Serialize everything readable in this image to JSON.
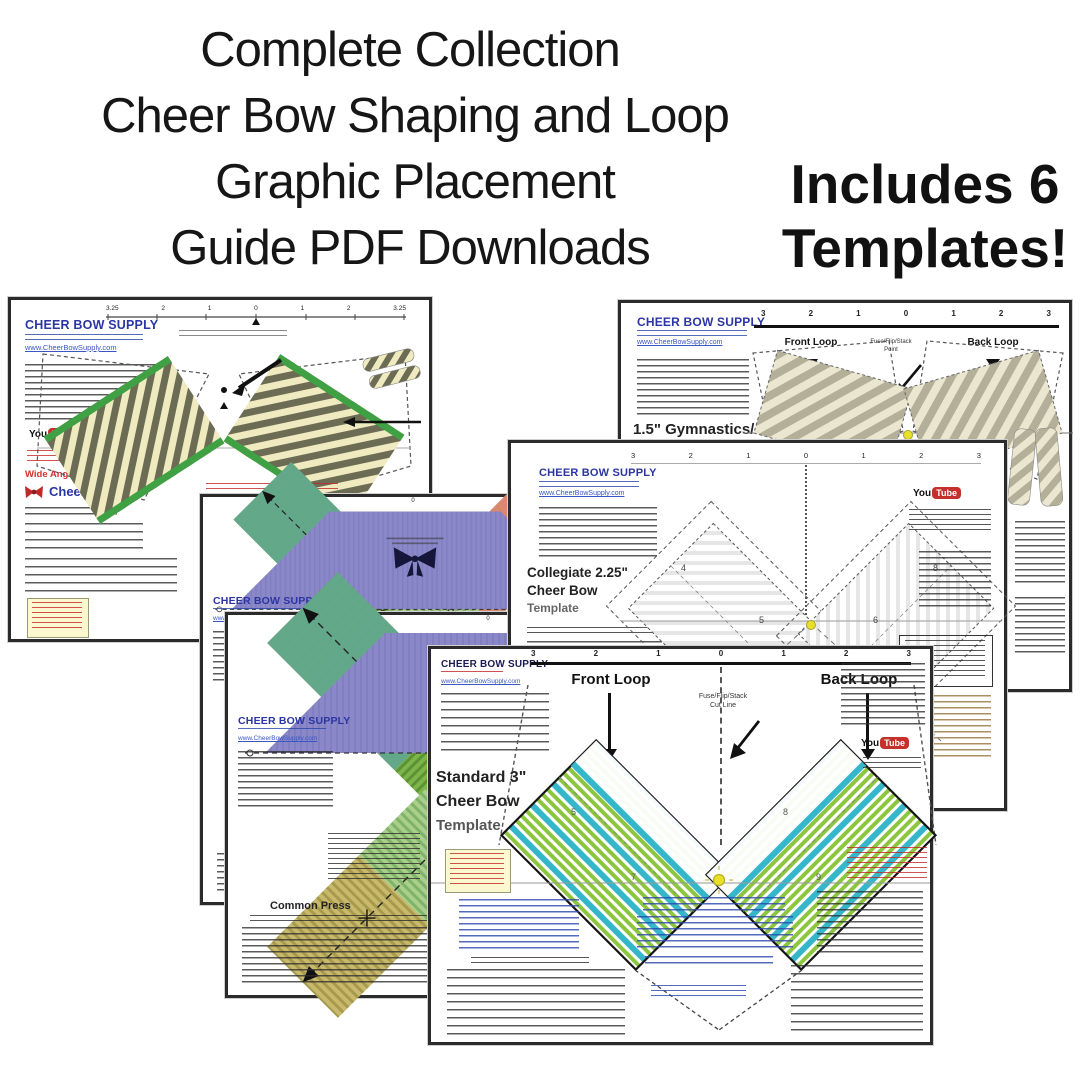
{
  "header": {
    "line1": "Complete Collection",
    "line2": "Cheer Bow Shaping and Loop",
    "line3": "Graphic Placement",
    "line4": "Guide PDF Downloads",
    "badge_line1": "Includes 6",
    "badge_line2": "Templates!"
  },
  "brand": {
    "logo": "CHEER BOW SUPPLY",
    "website": "www.CheerBowSupply.com",
    "youtube_you": "You",
    "youtube_tube": "Tube"
  },
  "colors": {
    "accent_blue": "#2b35a3",
    "link_blue": "#3a56c4",
    "red": "#cc2222",
    "youtube_red": "#c4302b",
    "stripe_cream": "#efeabf",
    "stripe_olive": "#6c6b54",
    "trim_green": "#3fa044",
    "stripe_gray": "#b3af99",
    "purple": "#8a88c8",
    "teal": "#63a88e",
    "salmon": "#dd8570",
    "band_green": "#7db54a",
    "tan": "#c0b065",
    "loop_green": "#8cc63f",
    "loop_cyan": "#35b6c9",
    "dot_yellow": "#e8e028"
  },
  "templates": {
    "wide_angle": {
      "label": "Wide Angle - Short Tail",
      "brand_name": "Cheer Bow",
      "ruler": [
        "3.25",
        "2",
        "1",
        "0",
        "1",
        "2",
        "3.25"
      ]
    },
    "gymnastics": {
      "title": "1.5\" Gymnastics/",
      "front_loop": "Front Loop",
      "back_loop": "Back Loop",
      "center_label_line1": "Fuse/Flip/Stack",
      "center_label_line2": "Point",
      "ruler": [
        "3",
        "2",
        "1",
        "0",
        "1",
        "2",
        "3"
      ]
    },
    "collegiate": {
      "title_line1": "Collegiate 2.25\"",
      "title_line2": "Cheer Bow",
      "title_line3": "Template",
      "ruler": [
        "3",
        "2",
        "1",
        "0",
        "1",
        "2",
        "3"
      ],
      "loop_numbers": [
        "4",
        "5",
        "6",
        "8"
      ]
    },
    "x_template_1": {
      "ruler": [
        "1",
        "0",
        "1"
      ]
    },
    "x_template_2": {
      "ruler": [
        "1",
        "0",
        "2"
      ],
      "section_header": "Common Press"
    },
    "standard": {
      "title_line1": "Standard 3\"",
      "title_line2": "Cheer Bow",
      "title_line3": "Template",
      "front_loop": "Front Loop",
      "back_loop": "Back Loop",
      "center_label_line1": "Fuse/Flip/Stack",
      "center_label_line2": "Cut Line",
      "ruler": [
        "3",
        "2",
        "1",
        "0",
        "1",
        "2",
        "3"
      ],
      "loop_numbers_left": [
        "5",
        "7"
      ],
      "loop_numbers_right": [
        "8",
        "9"
      ]
    }
  }
}
